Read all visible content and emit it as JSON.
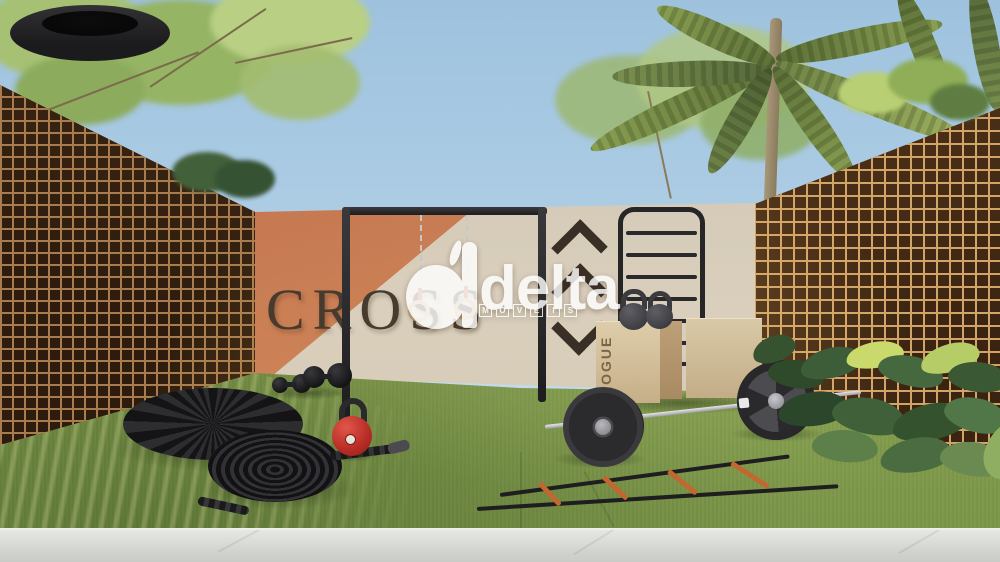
{
  "scene": {
    "wall_text": "CROSS",
    "box_brand": "ROGUE",
    "wall_decor_icons": [
      "chevron-up-icon",
      "chevron-up-icon",
      "chevron-down-icon"
    ],
    "equipment": [
      "pullup-rig",
      "gym-rings",
      "stall-bars",
      "kettlebells",
      "plyo-boxes",
      "barbell",
      "tractor-tire",
      "battle-rope",
      "dumbbells",
      "agility-ladder"
    ]
  },
  "watermark": {
    "brand": "delta",
    "subtitle_letters": [
      "I",
      "M",
      "Ó",
      "V",
      "E",
      "I",
      "S"
    ]
  },
  "colors": {
    "sky": "#aecde5",
    "turf": "#85a050",
    "wall_cream": "#d5cbba",
    "wall_orange": "#c67a52",
    "lattice_wood": "#c08a56",
    "cross_text": "#473a2e",
    "ladder_rung_orange": "#c2672f",
    "kettlebell_red": "#c0332b",
    "watermark_white": "#ffffff"
  }
}
